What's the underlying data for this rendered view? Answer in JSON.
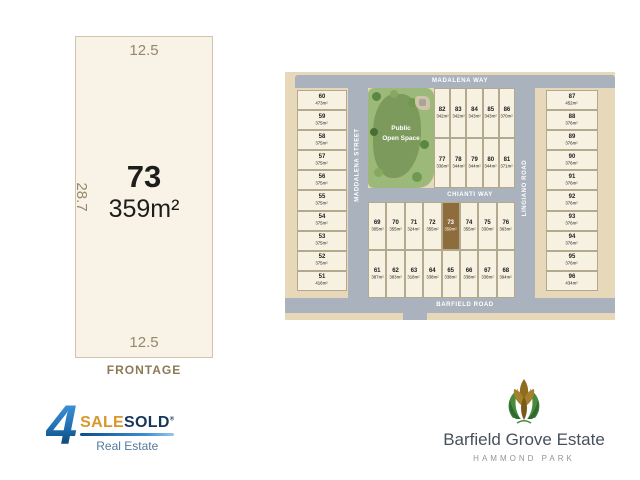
{
  "colors": {
    "map-bg": "#e8d8ba",
    "road": "#a9b2bd",
    "lot-fill": "#f7f1e2",
    "lot-border": "#b3a98f",
    "hl": "#8e6d3c",
    "parcel-fill": "#f8f3e6",
    "parcel-border": "#cfc5ad",
    "dim": "#97866a",
    "frontage": "#8c7a55",
    "open-space": "#9db97a",
    "open-space-dark": "#7d9a5d",
    "logo-gold": "#d9972b",
    "logo-navy": "#16365c",
    "logo-gray": "#53799f",
    "estate-text": "#47505b",
    "estate-sub": "#91968e"
  },
  "lot_panel": {
    "top_dim": "12.5",
    "left_dim": "28.7",
    "bottom_dim": "12.5",
    "lot_number": "73",
    "lot_area": "359m²",
    "frontage_label": "FRONTAGE"
  },
  "map": {
    "streets": {
      "top": "MADALENA WAY",
      "left": "MADDALENA STREET",
      "middle": "CHIANTI WAY",
      "right": "LINGIANO ROAD",
      "bottom": "BARFIELD ROAD"
    },
    "open_space": {
      "label_line1": "Public",
      "label_line2": "Open Space"
    },
    "left_column": [
      {
        "num": "60",
        "size": "473m²"
      },
      {
        "num": "59",
        "size": "375m²"
      },
      {
        "num": "58",
        "size": "375m²"
      },
      {
        "num": "57",
        "size": "375m²"
      },
      {
        "num": "56",
        "size": "375m²"
      },
      {
        "num": "55",
        "size": "375m²"
      },
      {
        "num": "54",
        "size": "375m²"
      },
      {
        "num": "53",
        "size": "375m²"
      },
      {
        "num": "52",
        "size": "375m²"
      },
      {
        "num": "51",
        "size": "416m²"
      }
    ],
    "top_block_row1": [
      {
        "num": "82",
        "size": "342m²"
      },
      {
        "num": "83",
        "size": "342m²"
      },
      {
        "num": "84",
        "size": "343m²"
      },
      {
        "num": "85",
        "size": "343m²"
      },
      {
        "num": "86",
        "size": "370m²"
      }
    ],
    "top_block_row2": [
      {
        "num": "77",
        "size": "336m²"
      },
      {
        "num": "78",
        "size": "344m²"
      },
      {
        "num": "79",
        "size": "344m²"
      },
      {
        "num": "80",
        "size": "344m²"
      },
      {
        "num": "81",
        "size": "371m²"
      }
    ],
    "mid_block_row1": [
      {
        "num": "69",
        "size": "305m²"
      },
      {
        "num": "70",
        "size": "355m²"
      },
      {
        "num": "71",
        "size": "324m²"
      },
      {
        "num": "72",
        "size": "355m²"
      },
      {
        "num": "73",
        "size": "359m²",
        "highlight": true
      },
      {
        "num": "74",
        "size": "355m²"
      },
      {
        "num": "75",
        "size": "330m²"
      },
      {
        "num": "76",
        "size": "363m²"
      }
    ],
    "mid_block_row2": [
      {
        "num": "61",
        "size": "387m²"
      },
      {
        "num": "62",
        "size": "383m²"
      },
      {
        "num": "63",
        "size": "318m²"
      },
      {
        "num": "64",
        "size": "338m²"
      },
      {
        "num": "65",
        "size": "338m²"
      },
      {
        "num": "66",
        "size": "338m²"
      },
      {
        "num": "67",
        "size": "338m²"
      },
      {
        "num": "68",
        "size": "394m²"
      }
    ],
    "right_column": [
      {
        "num": "87",
        "size": "452m²"
      },
      {
        "num": "88",
        "size": "376m²"
      },
      {
        "num": "89",
        "size": "376m²"
      },
      {
        "num": "90",
        "size": "376m²"
      },
      {
        "num": "91",
        "size": "376m²"
      },
      {
        "num": "92",
        "size": "376m²"
      },
      {
        "num": "93",
        "size": "376m²"
      },
      {
        "num": "94",
        "size": "376m²"
      },
      {
        "num": "95",
        "size": "376m²"
      },
      {
        "num": "96",
        "size": "434m²"
      }
    ]
  },
  "logos": {
    "foursalesold": {
      "four": "4",
      "sale": "SALE",
      "sold": "SOLD",
      "reg": "®",
      "tagline": "Real Estate"
    },
    "estate": {
      "name": "Barfield Grove Estate",
      "location": "HAMMOND PARK"
    }
  }
}
